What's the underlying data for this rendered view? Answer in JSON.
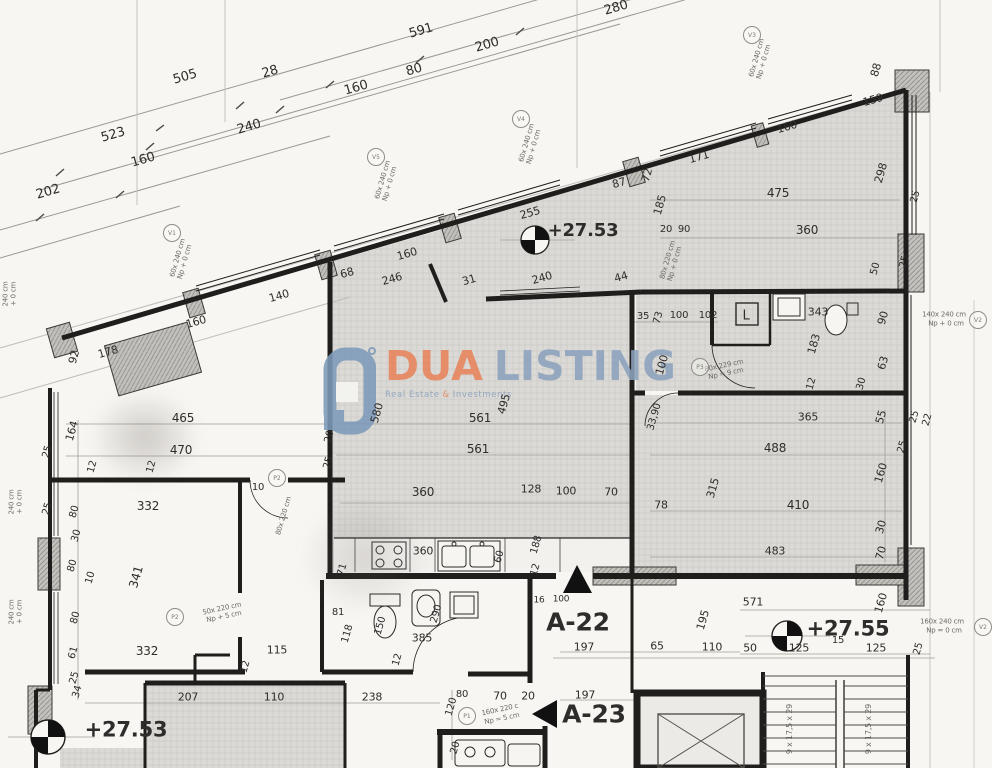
{
  "watermark": {
    "brand_primary": "DUA",
    "brand_secondary": "LISTING",
    "tagline_left": "Real Estate",
    "tagline_amp": "&",
    "tagline_right": "Investments",
    "primary_color": "#E8845B",
    "secondary_color": "#8CA2BD"
  },
  "labels": [
    {
      "t": "505",
      "x": 185,
      "y": 77,
      "r": -16,
      "s": 13
    },
    {
      "t": "28",
      "x": 270,
      "y": 72,
      "r": -16,
      "s": 13
    },
    {
      "t": "591",
      "x": 421,
      "y": 31,
      "r": -16,
      "s": 13
    },
    {
      "t": "200",
      "x": 487,
      "y": 45,
      "r": -16,
      "s": 13
    },
    {
      "t": "80",
      "x": 414,
      "y": 70,
      "r": -16,
      "s": 13
    },
    {
      "t": "160",
      "x": 356,
      "y": 88,
      "r": -16,
      "s": 13
    },
    {
      "t": "523",
      "x": 113,
      "y": 135,
      "r": -16,
      "s": 13
    },
    {
      "t": "240",
      "x": 249,
      "y": 127,
      "r": -16,
      "s": 13
    },
    {
      "t": "160",
      "x": 143,
      "y": 160,
      "r": -16,
      "s": 13
    },
    {
      "t": "202",
      "x": 48,
      "y": 192,
      "r": -16,
      "s": 13
    },
    {
      "t": "280",
      "x": 616,
      "y": 8,
      "r": -16,
      "s": 13
    },
    {
      "t": "92",
      "x": 74,
      "y": 357,
      "r": -74,
      "s": 11
    },
    {
      "t": "178",
      "x": 108,
      "y": 352,
      "r": -16,
      "s": 11
    },
    {
      "t": "160",
      "x": 196,
      "y": 322,
      "r": -16,
      "s": 11
    },
    {
      "t": "140",
      "x": 279,
      "y": 296,
      "r": -16,
      "s": 11
    },
    {
      "t": "68",
      "x": 347,
      "y": 273,
      "r": -16,
      "s": 11
    },
    {
      "t": "246",
      "x": 392,
      "y": 279,
      "r": -16,
      "s": 11
    },
    {
      "t": "160",
      "x": 407,
      "y": 254,
      "r": -16,
      "s": 11
    },
    {
      "t": "31",
      "x": 469,
      "y": 280,
      "r": -16,
      "s": 11
    },
    {
      "t": "240",
      "x": 542,
      "y": 278,
      "r": -16,
      "s": 11
    },
    {
      "t": "44",
      "x": 621,
      "y": 277,
      "r": -16,
      "s": 11
    },
    {
      "t": "255",
      "x": 530,
      "y": 213,
      "r": -16,
      "s": 11
    },
    {
      "t": "87",
      "x": 619,
      "y": 183,
      "r": -16,
      "s": 11
    },
    {
      "t": "72",
      "x": 647,
      "y": 175,
      "r": -74,
      "s": 11
    },
    {
      "t": "171",
      "x": 699,
      "y": 157,
      "r": -16,
      "s": 11
    },
    {
      "t": "160",
      "x": 787,
      "y": 127,
      "r": -16,
      "s": 11
    },
    {
      "t": "159",
      "x": 873,
      "y": 100,
      "r": -16,
      "s": 11
    },
    {
      "t": "298",
      "x": 881,
      "y": 173,
      "r": -74,
      "s": 11
    },
    {
      "t": "88",
      "x": 876,
      "y": 70,
      "r": -74,
      "s": 11
    },
    {
      "t": "25",
      "x": 916,
      "y": 197,
      "r": -74,
      "s": 10
    },
    {
      "t": "475",
      "x": 778,
      "y": 193,
      "s": 12
    },
    {
      "t": "360",
      "x": 807,
      "y": 230,
      "s": 12
    },
    {
      "t": "185",
      "x": 660,
      "y": 205,
      "r": -74,
      "s": 11
    },
    {
      "t": "20",
      "x": 666,
      "y": 230,
      "s": 10
    },
    {
      "t": "90",
      "x": 684,
      "y": 230,
      "s": 10
    },
    {
      "t": "50",
      "x": 876,
      "y": 269,
      "r": -74,
      "s": 10
    },
    {
      "t": "25",
      "x": 905,
      "y": 262,
      "r": -74,
      "s": 10
    },
    {
      "t": "35",
      "x": 643,
      "y": 317,
      "s": 10
    },
    {
      "t": "73",
      "x": 659,
      "y": 318,
      "r": -74,
      "s": 10
    },
    {
      "t": "100",
      "x": 679,
      "y": 316,
      "s": 10
    },
    {
      "t": "102",
      "x": 708,
      "y": 316,
      "s": 10
    },
    {
      "t": "100",
      "x": 662,
      "y": 365,
      "r": -74,
      "s": 11
    },
    {
      "t": "33,90",
      "x": 655,
      "y": 417,
      "r": -74,
      "s": 10
    },
    {
      "t": "L",
      "x": 746,
      "y": 316,
      "s": 13
    },
    {
      "t": "343",
      "x": 818,
      "y": 312,
      "s": 11
    },
    {
      "t": "183",
      "x": 814,
      "y": 344,
      "r": -74,
      "s": 11
    },
    {
      "t": "90",
      "x": 883,
      "y": 318,
      "r": -74,
      "s": 11
    },
    {
      "t": "63",
      "x": 883,
      "y": 363,
      "r": -74,
      "s": 11
    },
    {
      "t": "12",
      "x": 812,
      "y": 384,
      "r": -74,
      "s": 10
    },
    {
      "t": "30",
      "x": 862,
      "y": 384,
      "r": -74,
      "s": 10
    },
    {
      "t": "365",
      "x": 808,
      "y": 417,
      "s": 11
    },
    {
      "t": "55",
      "x": 881,
      "y": 417,
      "r": -74,
      "s": 11
    },
    {
      "t": "488",
      "x": 775,
      "y": 448,
      "s": 12
    },
    {
      "t": "160",
      "x": 881,
      "y": 473,
      "r": -74,
      "s": 11
    },
    {
      "t": "315",
      "x": 713,
      "y": 488,
      "r": -74,
      "s": 11
    },
    {
      "t": "410",
      "x": 798,
      "y": 505,
      "s": 12
    },
    {
      "t": "30",
      "x": 881,
      "y": 527,
      "r": -74,
      "s": 11
    },
    {
      "t": "70",
      "x": 881,
      "y": 553,
      "r": -74,
      "s": 11
    },
    {
      "t": "483",
      "x": 775,
      "y": 551,
      "s": 11
    },
    {
      "t": "78",
      "x": 661,
      "y": 505,
      "s": 11
    },
    {
      "t": "25",
      "x": 903,
      "y": 447,
      "r": -74,
      "s": 10
    },
    {
      "t": "25",
      "x": 915,
      "y": 417,
      "r": -74,
      "s": 10
    },
    {
      "t": "22",
      "x": 928,
      "y": 420,
      "r": -74,
      "s": 10
    },
    {
      "t": "580",
      "x": 377,
      "y": 413,
      "r": -74,
      "s": 11
    },
    {
      "t": "561",
      "x": 480,
      "y": 418,
      "s": 12
    },
    {
      "t": "561",
      "x": 478,
      "y": 449,
      "s": 12
    },
    {
      "t": "495",
      "x": 504,
      "y": 404,
      "r": -74,
      "s": 11
    },
    {
      "t": "360",
      "x": 423,
      "y": 492,
      "s": 12
    },
    {
      "t": "128",
      "x": 531,
      "y": 489,
      "s": 11
    },
    {
      "t": "100",
      "x": 566,
      "y": 491,
      "s": 11
    },
    {
      "t": "70",
      "x": 611,
      "y": 492,
      "s": 11
    },
    {
      "t": "20",
      "x": 330,
      "y": 437,
      "r": -74,
      "s": 10
    },
    {
      "t": "25",
      "x": 329,
      "y": 463,
      "r": -74,
      "s": 10
    },
    {
      "t": "188",
      "x": 537,
      "y": 545,
      "r": -74,
      "s": 10
    },
    {
      "t": "16",
      "x": 539,
      "y": 601,
      "s": 9
    },
    {
      "t": "100",
      "x": 561,
      "y": 600,
      "s": 9
    },
    {
      "t": "360",
      "x": 423,
      "y": 551,
      "s": 11
    },
    {
      "t": "60",
      "x": 500,
      "y": 557,
      "r": -74,
      "s": 10
    },
    {
      "t": "12",
      "x": 536,
      "y": 570,
      "r": -74,
      "s": 10
    },
    {
      "t": "71",
      "x": 343,
      "y": 570,
      "r": -74,
      "s": 10
    },
    {
      "t": "81",
      "x": 338,
      "y": 613,
      "s": 10
    },
    {
      "t": "118",
      "x": 348,
      "y": 634,
      "r": -74,
      "s": 10
    },
    {
      "t": "150",
      "x": 381,
      "y": 626,
      "r": -74,
      "s": 10
    },
    {
      "t": "290",
      "x": 437,
      "y": 614,
      "r": -74,
      "s": 10
    },
    {
      "t": "385",
      "x": 422,
      "y": 638,
      "s": 11
    },
    {
      "t": "12",
      "x": 398,
      "y": 660,
      "r": -74,
      "s": 10
    },
    {
      "t": "238",
      "x": 372,
      "y": 697,
      "s": 11
    },
    {
      "t": "120",
      "x": 452,
      "y": 707,
      "r": -74,
      "s": 10
    },
    {
      "t": "80",
      "x": 462,
      "y": 695,
      "s": 10
    },
    {
      "t": "70",
      "x": 500,
      "y": 696,
      "s": 11
    },
    {
      "t": "20",
      "x": 528,
      "y": 696,
      "s": 11
    },
    {
      "t": "20",
      "x": 456,
      "y": 748,
      "r": -74,
      "s": 10
    },
    {
      "t": "465",
      "x": 183,
      "y": 418,
      "s": 12
    },
    {
      "t": "470",
      "x": 181,
      "y": 450,
      "s": 12
    },
    {
      "t": "332",
      "x": 148,
      "y": 506,
      "s": 12
    },
    {
      "t": "341",
      "x": 136,
      "y": 577,
      "r": -74,
      "s": 12
    },
    {
      "t": "332",
      "x": 147,
      "y": 651,
      "s": 12
    },
    {
      "t": "12",
      "x": 152,
      "y": 467,
      "r": -74,
      "s": 10
    },
    {
      "t": "12",
      "x": 93,
      "y": 467,
      "r": -74,
      "s": 10
    },
    {
      "t": "10",
      "x": 258,
      "y": 488,
      "s": 10
    },
    {
      "t": "115",
      "x": 277,
      "y": 650,
      "s": 11
    },
    {
      "t": "12",
      "x": 246,
      "y": 667,
      "r": -74,
      "s": 10
    },
    {
      "t": "207",
      "x": 188,
      "y": 697,
      "s": 11
    },
    {
      "t": "110",
      "x": 274,
      "y": 697,
      "s": 11
    },
    {
      "t": "164",
      "x": 72,
      "y": 431,
      "r": -74,
      "s": 11
    },
    {
      "t": "25",
      "x": 48,
      "y": 452,
      "r": -74,
      "s": 10
    },
    {
      "t": "25",
      "x": 48,
      "y": 509,
      "r": -74,
      "s": 10
    },
    {
      "t": "80",
      "x": 75,
      "y": 512,
      "r": -74,
      "s": 10
    },
    {
      "t": "30",
      "x": 77,
      "y": 536,
      "r": -74,
      "s": 10
    },
    {
      "t": "80",
      "x": 73,
      "y": 566,
      "r": -74,
      "s": 10
    },
    {
      "t": "10",
      "x": 91,
      "y": 578,
      "r": -74,
      "s": 10
    },
    {
      "t": "80",
      "x": 76,
      "y": 618,
      "r": -74,
      "s": 10
    },
    {
      "t": "61",
      "x": 74,
      "y": 653,
      "r": -74,
      "s": 10
    },
    {
      "t": "25",
      "x": 75,
      "y": 678,
      "r": -74,
      "s": 10
    },
    {
      "t": "34",
      "x": 78,
      "y": 692,
      "r": -74,
      "s": 10
    },
    {
      "t": "197",
      "x": 584,
      "y": 647,
      "s": 11
    },
    {
      "t": "65",
      "x": 657,
      "y": 646,
      "s": 11
    },
    {
      "t": "110",
      "x": 712,
      "y": 647,
      "s": 11
    },
    {
      "t": "195",
      "x": 703,
      "y": 620,
      "r": -74,
      "s": 11
    },
    {
      "t": "197",
      "x": 585,
      "y": 695,
      "s": 11
    },
    {
      "t": "571",
      "x": 753,
      "y": 602,
      "s": 11
    },
    {
      "t": "160",
      "x": 881,
      "y": 603,
      "r": -74,
      "s": 11
    },
    {
      "t": "15",
      "x": 838,
      "y": 641,
      "s": 10
    },
    {
      "t": "125",
      "x": 799,
      "y": 648,
      "s": 11
    },
    {
      "t": "125",
      "x": 876,
      "y": 648,
      "s": 11
    },
    {
      "t": "50",
      "x": 750,
      "y": 648,
      "s": 11
    },
    {
      "t": "25",
      "x": 919,
      "y": 649,
      "r": -74,
      "s": 10
    },
    {
      "t": "+27.53",
      "x": 583,
      "y": 231,
      "s": 18,
      "b": true,
      "n": "level-annotation"
    },
    {
      "t": "+27.53",
      "x": 126,
      "y": 730,
      "s": 21,
      "b": true,
      "n": "level-annotation"
    },
    {
      "t": "+27.55",
      "x": 848,
      "y": 629,
      "s": 21,
      "b": true,
      "n": "level-annotation"
    },
    {
      "t": "A-22",
      "x": 578,
      "y": 622,
      "s": 25,
      "b": true,
      "n": "unit-label-a22"
    },
    {
      "t": "A-23",
      "x": 594,
      "y": 714,
      "s": 25,
      "b": true,
      "n": "unit-label-a23"
    },
    {
      "t": "9 x 17,5 x 29",
      "x": 790,
      "y": 729,
      "r": -90,
      "s": 8,
      "n": "stair-note"
    },
    {
      "t": "9 x 17,5 x 29",
      "x": 869,
      "y": 729,
      "r": -90,
      "s": 8,
      "n": "stair-note"
    },
    {
      "t": "80x 220 cm",
      "x": 668,
      "y": 260,
      "r": -74,
      "s": 7,
      "n": "opening-note"
    },
    {
      "t": "Np + 0 cm",
      "x": 675,
      "y": 264,
      "r": -74,
      "s": 7,
      "n": "opening-note"
    },
    {
      "t": "80x 229 cm",
      "x": 724,
      "y": 366,
      "r": -12,
      "s": 7,
      "n": "opening-note"
    },
    {
      "t": "Np = 9 cm",
      "x": 726,
      "y": 374,
      "r": -12,
      "s": 7,
      "n": "opening-note"
    },
    {
      "t": "50x 220 cm",
      "x": 222,
      "y": 609,
      "r": -12,
      "s": 7,
      "n": "opening-note"
    },
    {
      "t": "Np + 5 cm",
      "x": 224,
      "y": 617,
      "r": -12,
      "s": 7,
      "n": "opening-note"
    },
    {
      "t": "160x 220 c",
      "x": 500,
      "y": 710,
      "r": -12,
      "s": 7,
      "n": "opening-note"
    },
    {
      "t": "Np = 5 cm",
      "x": 502,
      "y": 719,
      "r": -12,
      "s": 7,
      "n": "opening-note"
    },
    {
      "t": "140x 240 cm",
      "x": 944,
      "y": 315,
      "s": 7,
      "n": "opening-note"
    },
    {
      "t": "Np + 0 cm",
      "x": 946,
      "y": 324,
      "s": 7,
      "n": "opening-note"
    },
    {
      "t": "160x 240 cm",
      "x": 942,
      "y": 622,
      "s": 7,
      "n": "opening-note"
    },
    {
      "t": "Np = 0 cm",
      "x": 944,
      "y": 631,
      "s": 7,
      "n": "opening-note"
    },
    {
      "t": "240 cm",
      "x": 12,
      "y": 502,
      "r": -90,
      "s": 7,
      "n": "opening-note"
    },
    {
      "t": "+ 0 cm",
      "x": 20,
      "y": 502,
      "r": -90,
      "s": 7,
      "n": "opening-note"
    },
    {
      "t": "240 cm",
      "x": 12,
      "y": 612,
      "r": -90,
      "s": 7,
      "n": "opening-note"
    },
    {
      "t": "+ 0 cm",
      "x": 20,
      "y": 612,
      "r": -90,
      "s": 7,
      "n": "opening-note"
    },
    {
      "t": "240 cm",
      "x": 6,
      "y": 294,
      "r": -90,
      "s": 7,
      "n": "opening-note"
    },
    {
      "t": "+ 0 cm",
      "x": 14,
      "y": 294,
      "r": -90,
      "s": 7,
      "n": "opening-note"
    },
    {
      "t": "60x 240 cm",
      "x": 178,
      "y": 258,
      "r": -74,
      "s": 7,
      "n": "opening-note"
    },
    {
      "t": "Np + 0 cm",
      "x": 185,
      "y": 262,
      "r": -74,
      "s": 7,
      "n": "opening-note"
    },
    {
      "t": "60x 240 cm",
      "x": 383,
      "y": 180,
      "r": -74,
      "s": 7,
      "n": "opening-note"
    },
    {
      "t": "Np + 0 cm",
      "x": 390,
      "y": 184,
      "r": -74,
      "s": 7,
      "n": "opening-note"
    },
    {
      "t": "60x 240 cm",
      "x": 527,
      "y": 143,
      "r": -74,
      "s": 7,
      "n": "opening-note"
    },
    {
      "t": "Np + 0 cm",
      "x": 534,
      "y": 147,
      "r": -74,
      "s": 7,
      "n": "opening-note"
    },
    {
      "t": "60x 240 cm",
      "x": 757,
      "y": 58,
      "r": -74,
      "s": 7,
      "n": "opening-note"
    },
    {
      "t": "Np + 0 cm",
      "x": 764,
      "y": 62,
      "r": -74,
      "s": 7,
      "n": "opening-note"
    },
    {
      "t": "80x 220 cm",
      "x": 284,
      "y": 516,
      "r": -74,
      "s": 7,
      "n": "opening-note"
    }
  ],
  "markers": [
    {
      "t": "V1",
      "x": 172,
      "y": 233
    },
    {
      "t": "V5",
      "x": 376,
      "y": 157
    },
    {
      "t": "V4",
      "x": 521,
      "y": 119
    },
    {
      "t": "V3",
      "x": 752,
      "y": 35
    },
    {
      "t": "V2",
      "x": 978,
      "y": 320
    },
    {
      "t": "V2",
      "x": 983,
      "y": 627
    },
    {
      "t": "P1",
      "x": 467,
      "y": 716
    },
    {
      "t": "P2",
      "x": 175,
      "y": 617
    },
    {
      "t": "P2",
      "x": 277,
      "y": 478
    },
    {
      "t": "P3",
      "x": 700,
      "y": 367
    }
  ]
}
